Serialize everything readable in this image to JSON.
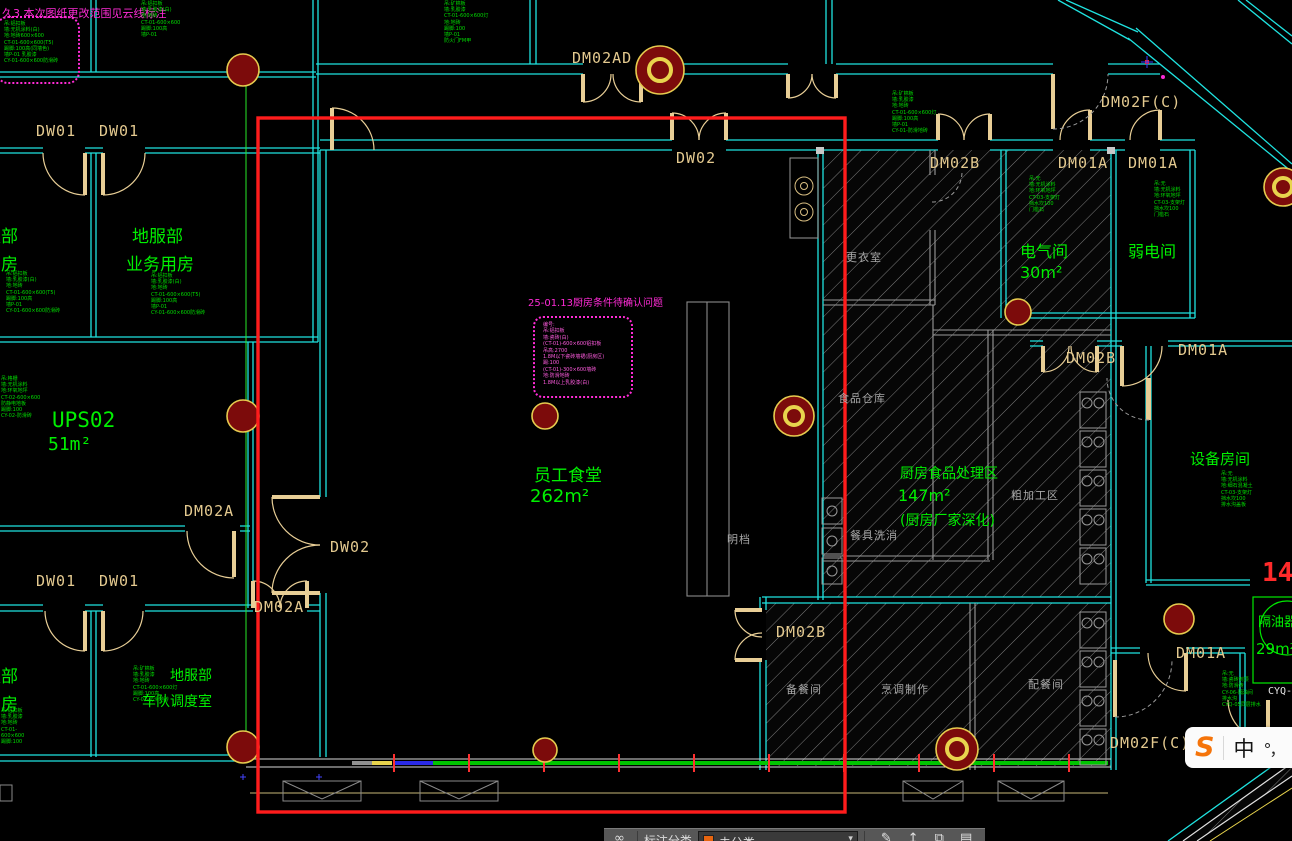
{
  "canvas_title": "CAD floor plan – staff canteen / kitchen area",
  "colors": {
    "wall_cyan": "#1FE3E0",
    "room_green": "#00F000",
    "door_tan": "#E3C98F",
    "zone_gray": "#A8A8A8",
    "revision_magenta": "#FF2BD6",
    "highlight_red": "#FF1C1C",
    "hydrant_fill": "#7C0B0B",
    "hydrant_ring": "#E6CB4F",
    "band_green": "#00C400",
    "band_blue": "#2A2AE8",
    "band_yellow": "#E8D44D",
    "toolbar_orange": "#E8650F"
  },
  "rooms": [
    {
      "line1": "服部",
      "line2": "用房"
    },
    {
      "line1": "地服部",
      "line2": "业务用房"
    },
    {
      "line1": "UPS02",
      "line2": "51m²"
    },
    {
      "line1": "员工食堂",
      "line2": "262m²"
    },
    {
      "line1": "电气间",
      "line2": "30m²"
    },
    {
      "line1": "弱电间"
    },
    {
      "line1": "设备房间"
    },
    {
      "line1": "厨房食品处理区",
      "line2": "147m²",
      "line3": "(厨房厂家深化)"
    },
    {
      "line1": "地服部",
      "line2": "车队调度室"
    },
    {
      "line1": "服部",
      "line2": "用房"
    },
    {
      "line1": "隔油器",
      "line2": "29m²"
    }
  ],
  "door_labels": [
    "DW01",
    "DW01",
    "DM02AD",
    "DW02",
    "DM02B",
    "DM01A",
    "DM01A",
    "DM02F(C)",
    "DM02A",
    "DW02",
    "DM02A",
    "DW01",
    "DW01",
    "DM02B",
    "DM01A",
    "DM02B",
    "DM01A",
    "DM02F(C)"
  ],
  "zone_labels": [
    "更衣室",
    "食品仓库",
    "粗加工区",
    "餐具洗消",
    "明档",
    "备餐间",
    "烹调制作",
    "配餐间"
  ],
  "clouds": {
    "top_left_title": "久3 本次图纸更改范围见云线标注",
    "top_left_lines": [
      "吊:铝扣板",
      "墙:无机涂料(白)",
      "地:地砖600×600",
      "CT-01-600×600(T5)",
      "踢脚:100高(同墙色)",
      "墙P-01 乳胶漆",
      "CY-01-600×600防滑砖"
    ],
    "center_title": "25-01.13厨房条件待确认问题",
    "center_lines": [
      "编号:",
      "吊:铝扣板",
      "墙:瓷砖(白)",
      "(CT-01)-600×600铝扣板",
      "吊高:2700",
      "1.8M以下瓷砖墙裙(厨房区)",
      "踢:100",
      "(CT-01)-300×600墙砖",
      "地:防滑地砖",
      "1.8M以上乳胶漆(白)"
    ]
  },
  "spec_blocks": [
    {
      "lines": [
        "吊:铝扣板",
        "墙:乳胶漆(白)",
        "地:地砖",
        "CT-01-600×600(T5)",
        "踢脚:100高",
        "墙P-01",
        "CY-01-600×600防滑砖"
      ]
    },
    {
      "lines": [
        "吊:铝扣板",
        "墙:乳胶漆(白)",
        "地:地砖",
        "CT-01-600×600(T5)",
        "踢脚:100高",
        "墙P-01",
        "CY-01-600×600防滑砖"
      ]
    },
    {
      "lines": [
        "吊:格栅",
        "墙:无机涂料",
        "地:环氧地坪",
        "CT-02-600×600",
        "防静电地板",
        "踢脚:100",
        "CY-02-防滑砖"
      ]
    },
    {
      "lines": [
        "吊:矿棉板",
        "墙:乳胶漆",
        "地:地砖",
        "CT-01-600×600灯",
        "踢脚:100高",
        "墙P-01",
        "CY-01-防滑地砖"
      ]
    },
    {
      "lines": [
        "吊:无",
        "墙:无机涂料",
        "地:环氧地坪",
        "CT-03-支架灯",
        "挡水坎100",
        "门槛石"
      ]
    },
    {
      "lines": [
        "吊:无",
        "墙:无机涂料",
        "地:环氧地坪",
        "CT-03-支架灯",
        "挡水坎100",
        "门槛石"
      ]
    },
    {
      "lines": [
        "吊:无",
        "墙:无机涂料",
        "地:细石混凝土",
        "CT-03-支架灯",
        "挡水坎100",
        "排水沟盖板"
      ]
    },
    {
      "lines": [
        "吊:矿棉板",
        "墙:乳胶漆",
        "地:地砖",
        "CT-01-600×600灯",
        "踢脚:100高",
        "CY-01-防滑地砖"
      ]
    },
    {
      "lines": [
        "吊:铝扣板",
        "墙:乳胶漆",
        "地:地砖",
        "CT-01-600×600",
        "踢脚:100"
      ]
    },
    {
      "lines": [
        "吊:无",
        "墙:瓷砖到顶",
        "地:防滑砖",
        "CY-06-隔油间",
        "排水沟",
        "CYQ-05同层排水"
      ]
    },
    {
      "lines": [
        "吊:铝扣板",
        "墙:乳胶漆(白)",
        "地:地砖",
        "CT-01-600×600",
        "踢脚:100高",
        "墙P-01"
      ]
    },
    {
      "lines": [
        "吊:矿棉板",
        "墙:乳胶漆",
        "CT-01-600×600灯",
        "地:地砖",
        "踢脚:100",
        "墙P-01",
        "防火门FM甲"
      ]
    }
  ],
  "misc": {
    "red_number": "14",
    "cyq": "CYQ-"
  },
  "toolbar": {
    "infinity_icon": "∞",
    "category_label": "标注分类",
    "dropdown_value": "未分类",
    "caret": "▾",
    "edit_icon": "✎",
    "upload_icon": "↥",
    "copy_icon": "⧉",
    "save_icon": "▤"
  },
  "ime": {
    "logo": "S",
    "mode": "中",
    "punct": "°，"
  }
}
